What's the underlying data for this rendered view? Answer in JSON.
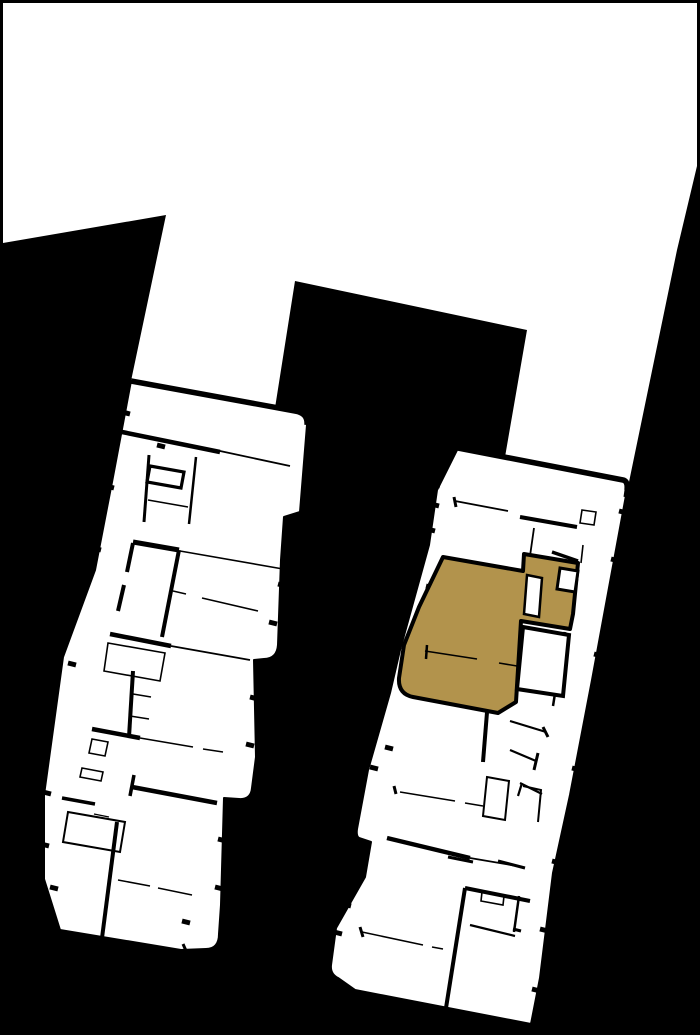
{
  "plan": {
    "description": "building-site-plan-with-highlighted-unit",
    "canvas": {
      "width": 700,
      "height": 1035
    },
    "colors": {
      "background": "#000000",
      "surface": "#ffffff",
      "outline": "#000000",
      "highlight": "#b2934c"
    },
    "sky": {
      "path": "M3,3 L697,3 L697,166 L677,250 L629,482 L505,457 L527,330 L295,281 L275,408 L131,381 L166,215 L3,243 Z"
    },
    "left_building": {
      "outline": "M131,381 L295,411 Q308,413 307,425 L300,512 L284,517 L281,560 L278,645 Q277,659 264,659 L254,660 L256,757 L252,788 Q251,800 239,799 L224,798 L221,905 L219,934 Q219,949 206,949 L181,950 L60,930 L44,879 L44,795 L63,657 L95,570 L112,482 Z",
      "top_wall": "M131,381 L295,411 Q308,413 307,425",
      "walls": [
        {
          "d": "M122,432 L220,452",
          "w": 4.5
        },
        {
          "d": "M220,451 L290,466",
          "w": 1.8
        },
        {
          "d": "M149,455 L144,522",
          "w": 3
        },
        {
          "d": "M196,457 L189,524",
          "w": 2.5
        },
        {
          "d": "M150,466 L184,472 L181,488 L147,482 Z",
          "w": 3.2
        },
        {
          "d": "M148,500 L188,507",
          "w": 1.5
        },
        {
          "d": "M133,542 L179,550",
          "w": 5
        },
        {
          "d": "M179,550 L162,637",
          "w": 4
        },
        {
          "d": "M133,543 L127,572",
          "w": 4
        },
        {
          "d": "M124,585 L118,611",
          "w": 4
        },
        {
          "d": "M180,551 L283,569",
          "w": 1.6
        },
        {
          "d": "M173,591 L186,594",
          "w": 1.5
        },
        {
          "d": "M202,598 L258,611",
          "w": 1.5
        },
        {
          "d": "M110,634 L171,646",
          "w": 4.5
        },
        {
          "d": "M171,646 L250,660",
          "w": 1.8
        },
        {
          "d": "M108,643 L165,653 L160,681 L104,671 Z",
          "w": 1.6
        },
        {
          "d": "M133,671 L129,737",
          "w": 4
        },
        {
          "d": "M133,694 L151,697",
          "w": 1.5
        },
        {
          "d": "M130,716 L149,719",
          "w": 1.5
        },
        {
          "d": "M92,729 L140,738",
          "w": 4.5
        },
        {
          "d": "M140,738 L193,747",
          "w": 1.5
        },
        {
          "d": "M203,749 L223,752",
          "w": 1.5
        },
        {
          "d": "M92,739 L108,742 L105,756 L89,753 Z",
          "w": 1.6
        },
        {
          "d": "M82,768 L103,772 L101,781 L80,777 Z",
          "w": 1.6
        },
        {
          "d": "M134,775 L130,796",
          "w": 3.5
        },
        {
          "d": "M132,787 L217,803",
          "w": 4.5
        },
        {
          "d": "M62,798 L95,804",
          "w": 3.5
        },
        {
          "d": "M68,812 L125,822 L120,852 L63,842 Z",
          "w": 2
        },
        {
          "d": "M94,814 L109,817",
          "w": 1.4
        },
        {
          "d": "M117,822 L102,938",
          "w": 4
        },
        {
          "d": "M118,880 L150,886",
          "w": 1.5
        },
        {
          "d": "M158,888 L192,895",
          "w": 1.5
        },
        {
          "d": "M183,944 L187,953",
          "w": 3
        }
      ],
      "ticks": [
        [
          126,
          413
        ],
        [
          110,
          487
        ],
        [
          97,
          549
        ],
        [
          72,
          664
        ],
        [
          47,
          793
        ],
        [
          45,
          845
        ],
        [
          54,
          888
        ],
        [
          282,
          585
        ],
        [
          273,
          623
        ],
        [
          254,
          698
        ],
        [
          250,
          745
        ],
        [
          222,
          840
        ],
        [
          219,
          888
        ],
        [
          161,
          446
        ],
        [
          186,
          922
        ]
      ]
    },
    "right_building": {
      "outline": "M458,448 L623,480 Q628,481 627,490 L592,680 L570,795 L553,873 L540,978 L531,1024 L355,990 L338,978 Q330,974 331,965 L336,928 L365,877 L371,842 L359,838 Q356,836 357,829 L368,770 L390,693 L400,650 L429,545 L437,490 Z",
      "top_wall": "M458,448 L623,480 Q628,481 627,490",
      "walls": [
        {
          "d": "M455,501 L508,511",
          "w": 1.8
        },
        {
          "d": "M454,497 L456,507",
          "w": 3
        },
        {
          "d": "M520,517 L577,527",
          "w": 4
        },
        {
          "d": "M582,510 L596,512 L594,525 L580,523 Z",
          "w": 1.6
        },
        {
          "d": "M534,528 L530,556",
          "w": 1.8
        },
        {
          "d": "M552,552 L578,561",
          "w": 3.5
        },
        {
          "d": "M627,483 L625,497",
          "w": 3
        },
        {
          "d": "M583,545 L581,563",
          "w": 1.6
        },
        {
          "d": "M488,700 L483,762",
          "w": 4
        },
        {
          "d": "M510,721 L546,732",
          "w": 2.2
        },
        {
          "d": "M543,727 L548,737",
          "w": 3
        },
        {
          "d": "M510,750 L536,761",
          "w": 2.2
        },
        {
          "d": "M538,753 L534,770",
          "w": 3
        },
        {
          "d": "M557,681 L553,706",
          "w": 2.5
        },
        {
          "d": "M540,676 L561,682",
          "w": 3
        },
        {
          "d": "M565,632 L562,652",
          "w": 3
        },
        {
          "d": "M520,783 L542,794",
          "w": 2.2
        },
        {
          "d": "M522,783 L518,796",
          "w": 2.2
        },
        {
          "d": "M400,792 L455,801",
          "w": 1.5
        },
        {
          "d": "M465,803 L483,806",
          "w": 1.5
        },
        {
          "d": "M394,786 L396,794",
          "w": 3
        },
        {
          "d": "M487,777 L509,781 L505,820 L483,816 Z",
          "w": 2
        },
        {
          "d": "M523,786 L541,790 L538,822",
          "w": 2
        },
        {
          "d": "M387,838 L470,858",
          "w": 4.5
        },
        {
          "d": "M470,858 L523,867",
          "w": 1.8
        },
        {
          "d": "M448,857 L473,862",
          "w": 3
        },
        {
          "d": "M498,861 L525,868",
          "w": 3
        },
        {
          "d": "M465,888 L446,1008",
          "w": 4
        },
        {
          "d": "M465,888 L530,901",
          "w": 4
        },
        {
          "d": "M482,892 L504,896 L503,905 L481,901 Z",
          "w": 1.6
        },
        {
          "d": "M519,896 L514,932",
          "w": 2.5
        },
        {
          "d": "M470,925 L515,936",
          "w": 2.2
        },
        {
          "d": "M513,929 L521,931",
          "w": 3
        },
        {
          "d": "M362,932 L423,945",
          "w": 1.5
        },
        {
          "d": "M432,947 L443,949",
          "w": 1.5
        },
        {
          "d": "M360,927 L363,937",
          "w": 3
        }
      ],
      "ticks": [
        [
          435,
          505
        ],
        [
          431,
          530
        ],
        [
          417,
          640
        ],
        [
          412,
          662
        ],
        [
          389,
          748
        ],
        [
          374,
          768
        ],
        [
          363,
          850
        ],
        [
          347,
          905
        ],
        [
          338,
          933
        ],
        [
          623,
          512
        ],
        [
          615,
          560
        ],
        [
          598,
          655
        ],
        [
          576,
          769
        ],
        [
          556,
          862
        ],
        [
          544,
          930
        ],
        [
          536,
          990
        ],
        [
          430,
          587
        ],
        [
          422,
          608
        ],
        [
          436,
          485
        ]
      ]
    },
    "highlight_unit": {
      "outline": "M443,557 L523,571 L524,554 L578,563 L573,614 L570,629 L521,621 L516,702 L498,713 L413,697 Q398,694 399,678 L404,645 L419,607 Z",
      "overlays": [
        {
          "name": "interior-room-cutout",
          "d": "M527,575 L542,578 L539,617 L524,614 Z",
          "w": 2.5
        },
        {
          "name": "stair-notch",
          "d": "M560,568 L578,571 L575,592 L557,589 Z",
          "w": 3
        },
        {
          "name": "adjacent-room-cutout",
          "d": "M523,627 L569,635 L563,696 L517,689 Z",
          "w": 4
        }
      ],
      "lines": [
        {
          "d": "M425,651 L477,659",
          "w": 1.6
        },
        {
          "d": "M499,663 L517,666",
          "w": 1.6
        },
        {
          "d": "M427,645 L426,659",
          "w": 2.5
        }
      ]
    }
  }
}
